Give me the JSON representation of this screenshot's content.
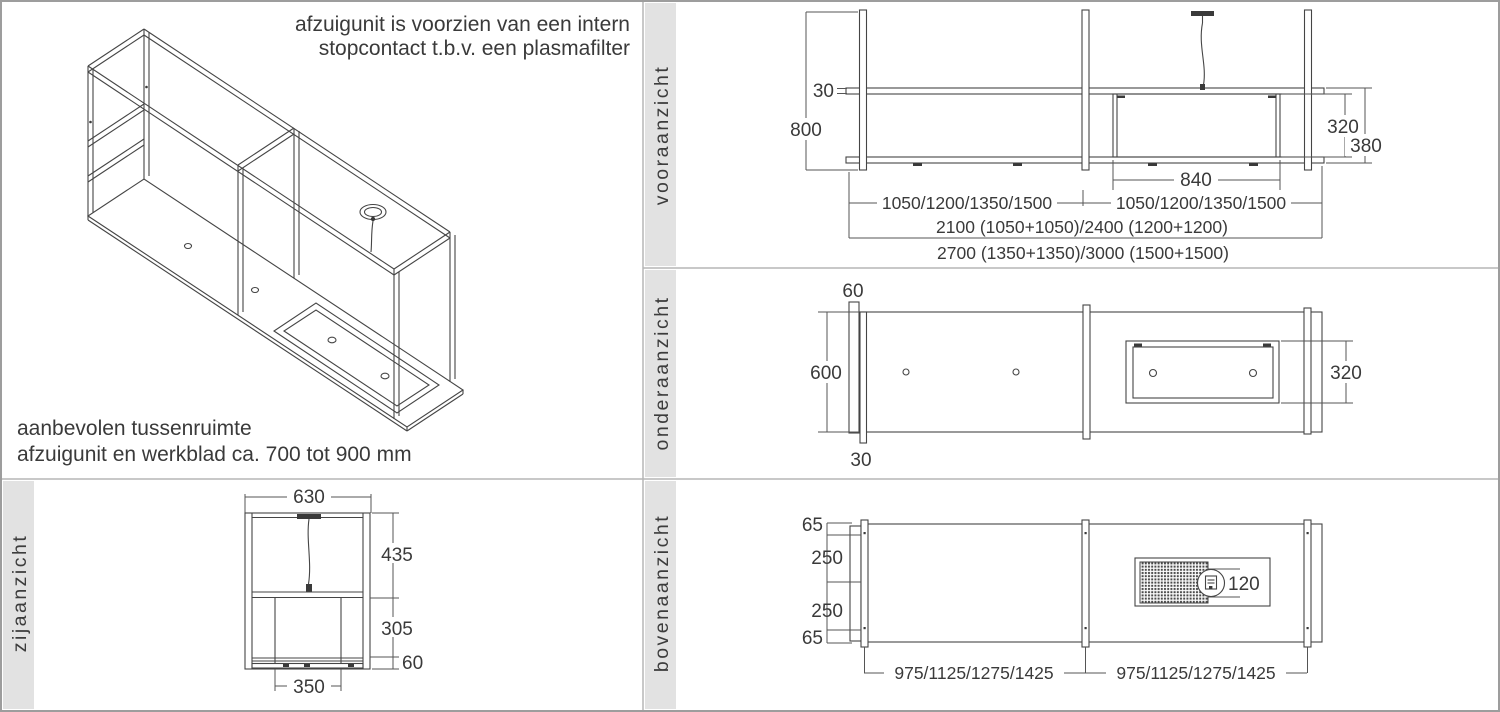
{
  "colors": {
    "line": "#454545",
    "dim_text": "#3a3a3a",
    "band": "#e2e2e2",
    "divider": "#b5b5b5",
    "border": "#9d9d9d"
  },
  "iso": {
    "note_line1": "afzuigunit is voorzien van een intern",
    "note_line2": "stopcontact t.b.v. een plasmafilter",
    "hint_line1": "aanbevolen tussenruimte",
    "hint_line2": "afzuigunit en werkblad ca. 700 tot 900 mm"
  },
  "front": {
    "label": "vooraanzicht",
    "d30": "30",
    "d800": "800",
    "d320": "320",
    "d380": "380",
    "d840": "840",
    "row1_left": "1050/1200/1350/1500",
    "row1_right": "1050/1200/1350/1500",
    "row2": "2100 (1050+1050)/2400 (1200+1200)",
    "row3": "2700 (1350+1350)/3000 (1500+1500)"
  },
  "under": {
    "label": "onderaanzicht",
    "d60": "60",
    "d600": "600",
    "d30": "30",
    "d320": "320"
  },
  "side": {
    "label": "zijaanzicht",
    "d630": "630",
    "d435": "435",
    "d305": "305",
    "d60": "60",
    "d350": "350"
  },
  "top": {
    "label": "bovenaanzicht",
    "d65_top": "65",
    "d250_upper": "250",
    "d250_lower": "250",
    "d65_bottom": "65",
    "d120": "120",
    "row_left": "975/1125/1275/1425",
    "row_right": "975/1125/1275/1425"
  }
}
